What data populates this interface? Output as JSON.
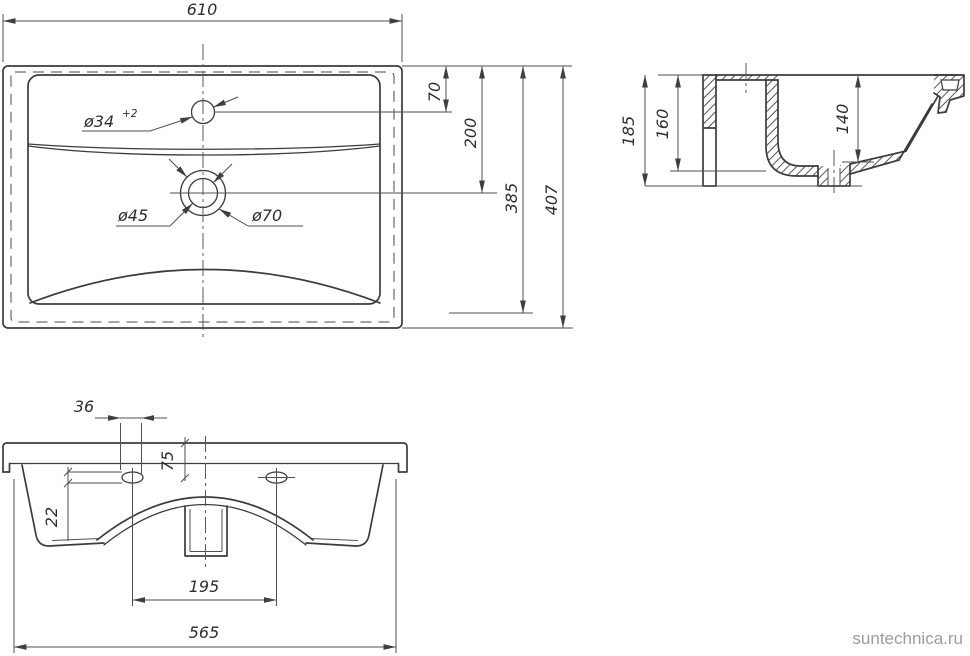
{
  "watermark": {
    "text": "suntechnica.ru"
  },
  "colors": {
    "line": "#3c3c3c",
    "thin_line": "#4f4f4f",
    "text": "#2e2e2e",
    "watermark": "#9c9c9c",
    "background": "#ffffff"
  },
  "top_view": {
    "overall_width": "610",
    "faucet_center_from_back": "70",
    "drain_center_from_back": "200",
    "bowl_depth_dim": "385",
    "overall_depth": "407",
    "faucet_hole_dia": "ø34",
    "faucet_hole_tolerance": "+2",
    "drain_hole_dia": "ø45",
    "drain_recess_dia": "ø70"
  },
  "section_view": {
    "overall_height": "185",
    "rear_height": "160",
    "bowl_inner_depth": "140"
  },
  "front_view": {
    "fix_hole_width": "36",
    "fix_hole_from_top": "75",
    "fix_hole_height": "22",
    "fix_holes_spacing": "195",
    "body_width": "565"
  }
}
